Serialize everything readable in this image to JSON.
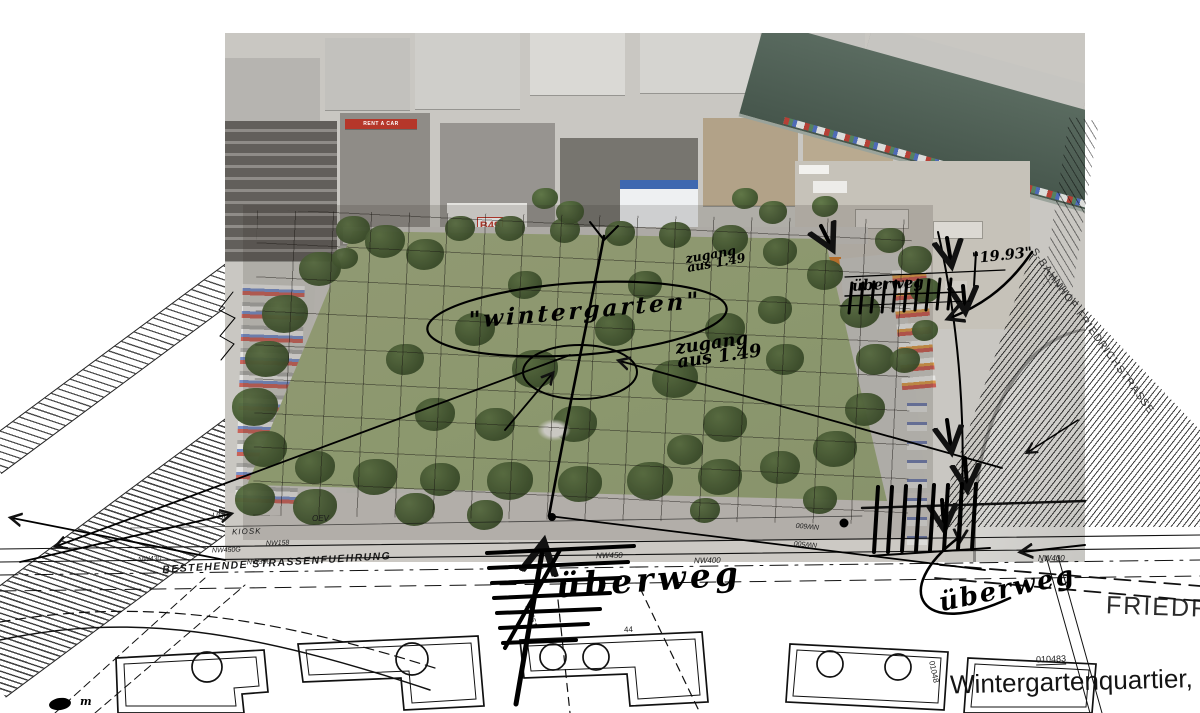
{
  "palette": {
    "paper": "#ffffff",
    "ink": "#111111",
    "park_green": "#9fae7e",
    "tree_green": "#42592f",
    "river": "#4d5f55",
    "asphalt": "#c9c7c2",
    "building_gray": "#a9a7a2",
    "roof_dark": "#77756f",
    "station_roof": "#d6d5d2",
    "accent_red": "#c0392b"
  },
  "photo": {
    "signs": {
      "rent_a_car": "RENT A CAR",
      "gable": "B49"
    }
  },
  "handwritten": {
    "wintergarten": "\"wintergarten\"",
    "zugang_top": {
      "line1": "zugang",
      "line2": "aus 1.49"
    },
    "zugang_main": {
      "line1": "zugang",
      "line2": "aus 1.49"
    },
    "ueberweg_top": "überweg",
    "measure_1993": "\"19.93\"",
    "ueberweg_center": "überweg",
    "ueberweg_right": "überweg",
    "meter_note": "m"
  },
  "plan": {
    "existing_street_note": "BESTEHENDE STRASSENFUEHRUNG",
    "quarter_title": "Wintergartenquartier, F",
    "street_friedrichstrasse": "FRIEDRICH",
    "station_label": "S-BAHNHOF FRIEDRICHSTRASSE",
    "point_labels": {
      "uhr": "UHR",
      "kiosk": "KIOSK",
      "oev": "OEV",
      "nw430": "NW430",
      "nw450g": "NW450G",
      "nw158": "NW158",
      "nw390": "NW390",
      "nw450": "NW450",
      "nw400_center": "NW400",
      "nw400_right": "NW400",
      "nw500": "NW500",
      "nw600": "NW600",
      "p10051": "10051",
      "p010483": "010483",
      "p01048": "01048",
      "n44": "44"
    }
  }
}
